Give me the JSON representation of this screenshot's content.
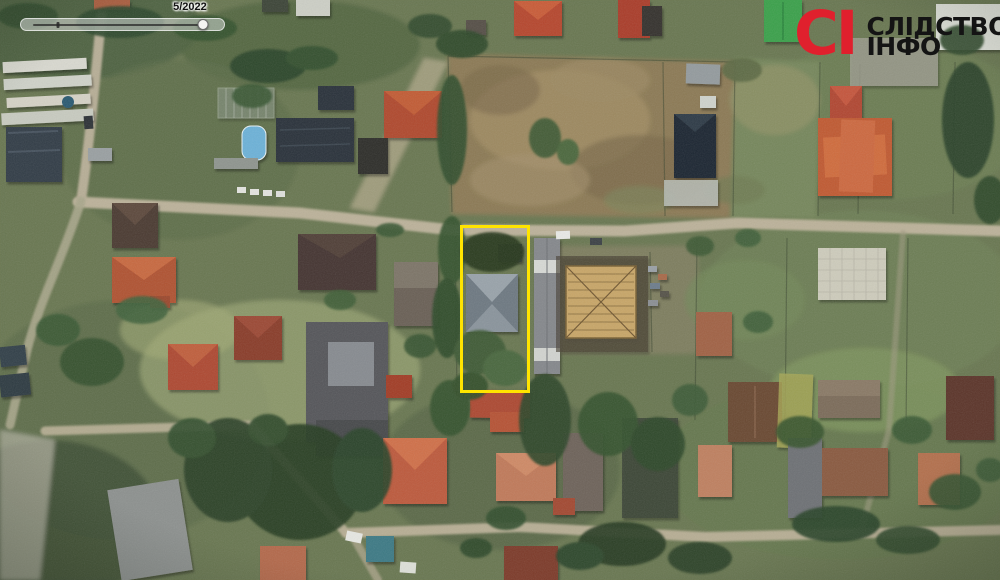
{
  "timeline": {
    "date_label": "5/2022",
    "progress_percent": 97,
    "tick_percent": 14
  },
  "watermark": {
    "abbr": "СІ",
    "title_line1": "СЛІДСТВО",
    "title_line2": "ІНФО",
    "accent_color": "#e0202d",
    "text_color": "#141414"
  },
  "highlight": {
    "color": "#ffe400",
    "x": 460,
    "y": 225,
    "width": 70,
    "height": 168
  },
  "palette": {
    "ground_green": "#697751",
    "field_brown": "#8c7a55",
    "road_tan": "#bcb29a",
    "tree_dark_green": "#2f4a2d",
    "roof_red": "#b04a2d",
    "roof_dark_slate": "#2a333b",
    "roof_gray": "#6e7982",
    "construction_tan": "#c8a668"
  }
}
